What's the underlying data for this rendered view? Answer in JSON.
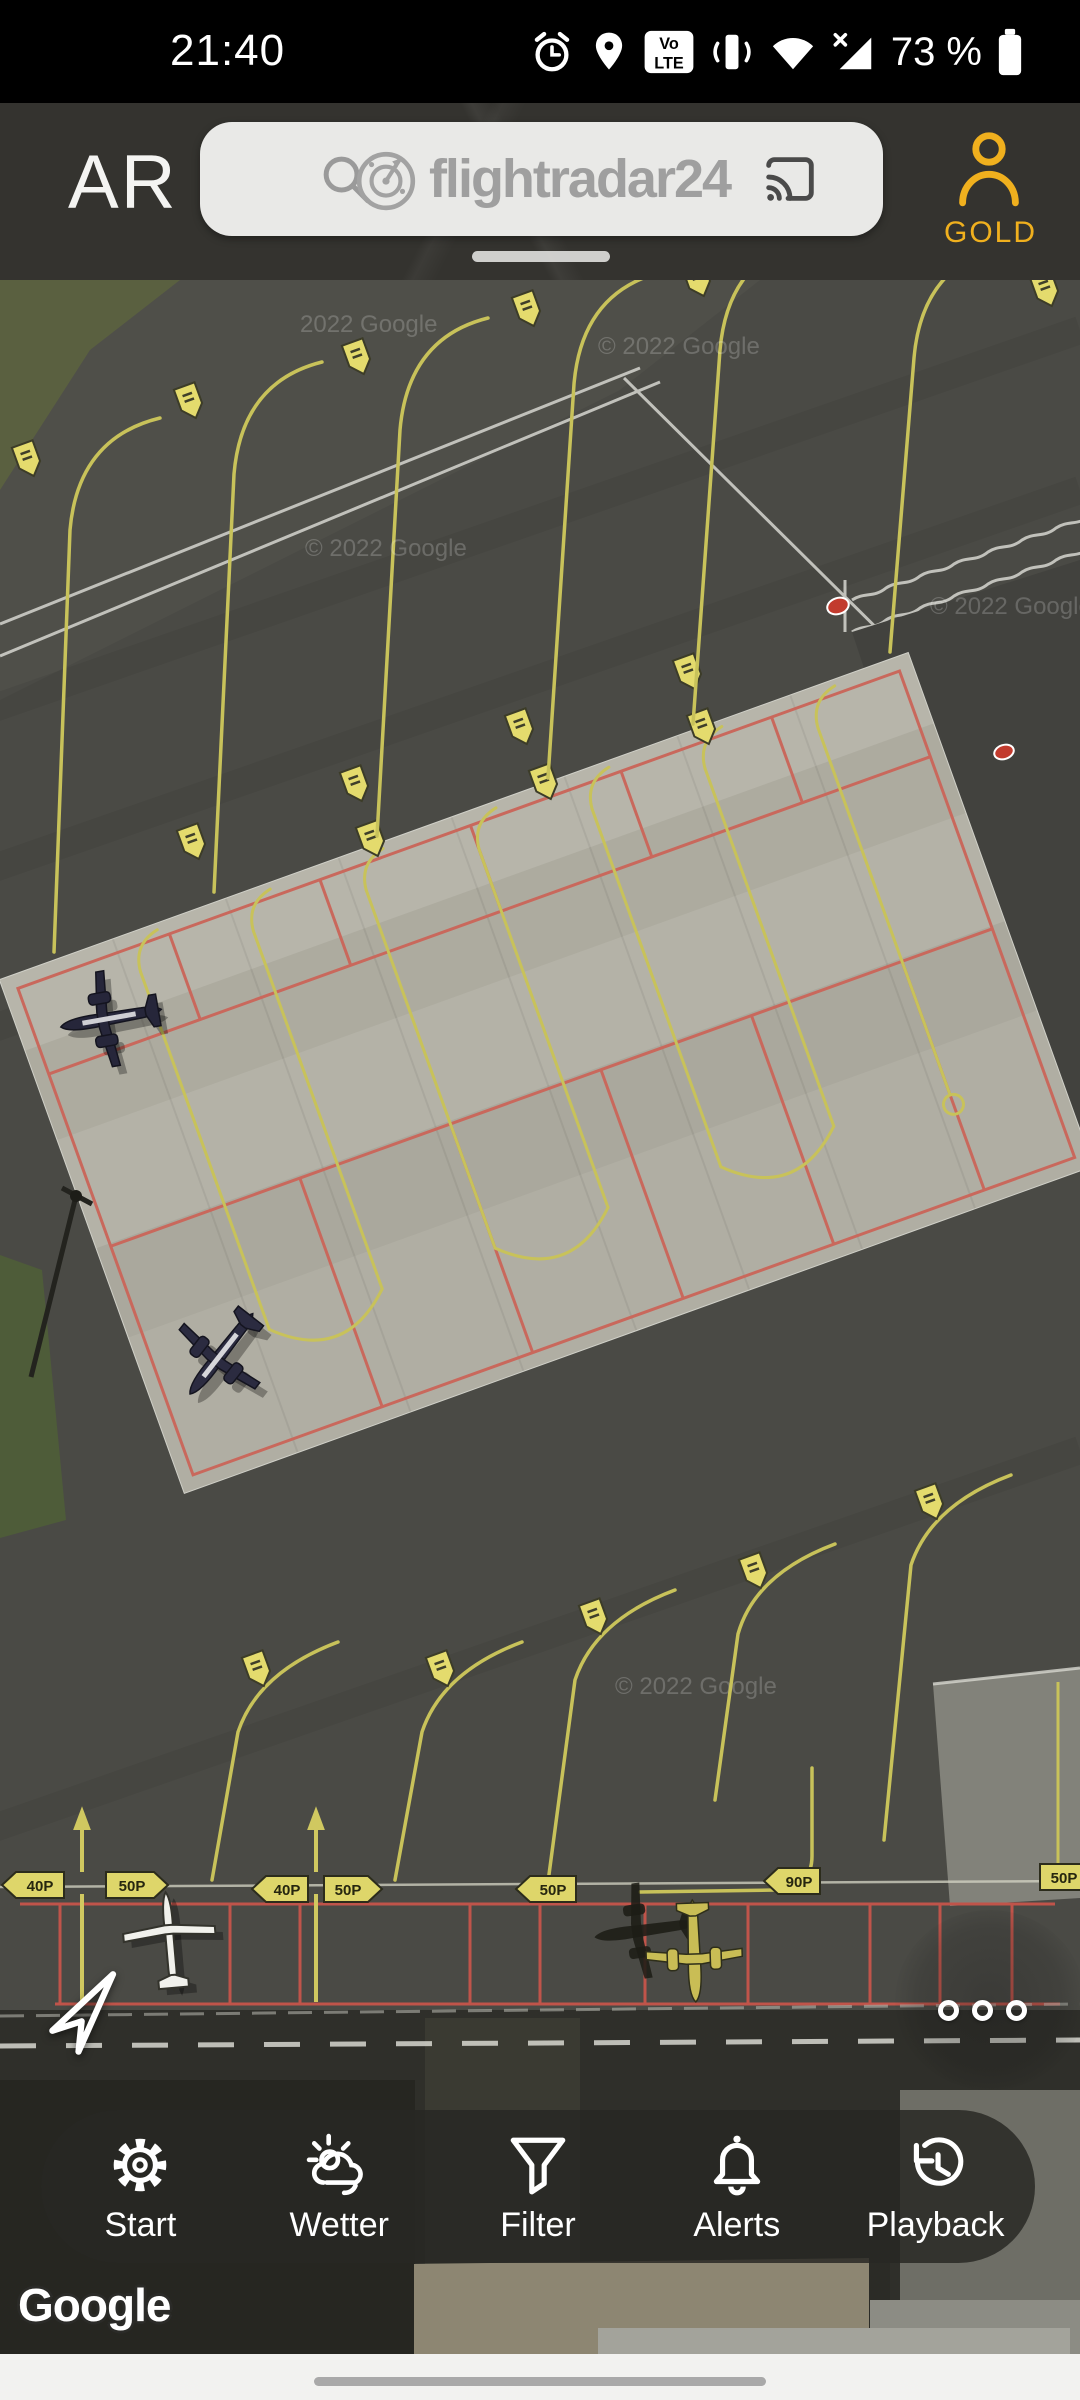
{
  "status_bar": {
    "time": "21:40",
    "battery": "73 %",
    "volte_top": "Vo",
    "volte_bottom": "LTE",
    "icons": [
      "alarm-icon",
      "location-pin-icon",
      "volte-icon",
      "vibrate-icon",
      "wifi-icon",
      "signal-x-icon",
      "battery-icon"
    ]
  },
  "header": {
    "ar": "AR",
    "search_placeholder": "flightradar24",
    "account_tier": "GOLD",
    "icons": [
      "search-icon",
      "radar-logo-icon",
      "cast-icon",
      "account-person-icon"
    ],
    "accent_gold": "#f0b01e"
  },
  "toolbar": {
    "items": [
      {
        "label": "Start",
        "icon": "gear-icon"
      },
      {
        "label": "Wetter",
        "icon": "weather-icon"
      },
      {
        "label": "Filter",
        "icon": "funnel-icon"
      },
      {
        "label": "Alerts",
        "icon": "bell-icon"
      },
      {
        "label": "Playback",
        "icon": "playback-clock-icon"
      }
    ]
  },
  "map": {
    "attribution_logo": "Google",
    "copyright": "© 2022 Google",
    "copyright_short": "2022 Google",
    "signs": {
      "s1l": "40P",
      "s1r": "50P",
      "s2l": "40P",
      "s2r": "50P",
      "s3": "50P",
      "s4": "90P",
      "s5": "50P"
    },
    "controls": [
      "locate-arrow-button",
      "more-options-dots"
    ],
    "colors": {
      "asphalt": "#4a4a45",
      "apron_concrete": "#b2b0a5",
      "taxiline_yellow": "#c8c25a",
      "stand_red": "#c9685c",
      "grass": "#59603f",
      "accent_gold": "#f0b01e"
    }
  }
}
